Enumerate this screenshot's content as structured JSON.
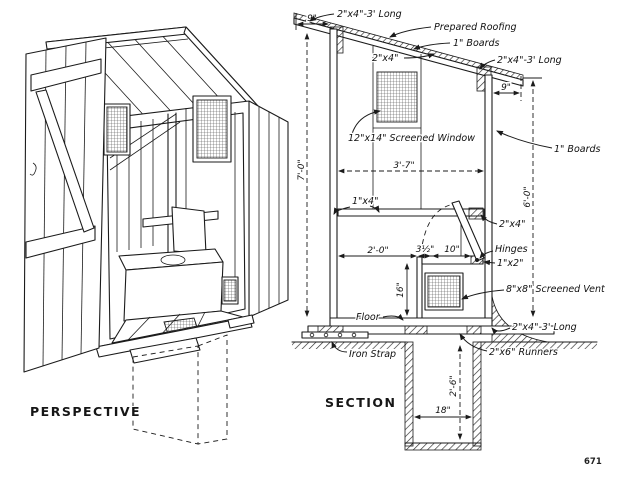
{
  "figure": {
    "perspective_title": "PERSPECTIVE",
    "section_title": "SECTION",
    "page_number": "671"
  },
  "section": {
    "labels": {
      "roof_stringer_top": "2\"x4\"-3' Long",
      "prepared_roofing": "Prepared Roofing",
      "roof_boards": "1\" Boards",
      "rafter_2x4": "2\"x4\"",
      "roof_stringer_right": "2\"x4\"-3' Long",
      "screened_window": "12\"x14\" Screened Window",
      "wall_boards": "1\" Boards",
      "rail_1x4": "1\"x4\"",
      "plate_2x4": "2\"x4\"",
      "hinges": "Hinges",
      "seat_trim_1x2": "1\"x2\"",
      "screened_vent": "8\"x8\" Screened Vent",
      "floor": "Floor",
      "sill_2x4": "2\"x4\"-3' Long",
      "iron_strap": "Iron Strap",
      "runners_2x6": "2\"x6\" Runners"
    },
    "dimensions": {
      "left_overhang": "9\"",
      "right_overhang": "9\"",
      "front_wall_height": "7'-0\"",
      "rear_wall_height": "6'-0\"",
      "interior_width": "3'-7\"",
      "seat_setback": "2'-0\"",
      "seat_gap": "3½\"",
      "seat_top_depth": "10\"",
      "seat_height": "16\"",
      "pit_depth": "2'-6\"",
      "pit_width": "18\""
    }
  }
}
